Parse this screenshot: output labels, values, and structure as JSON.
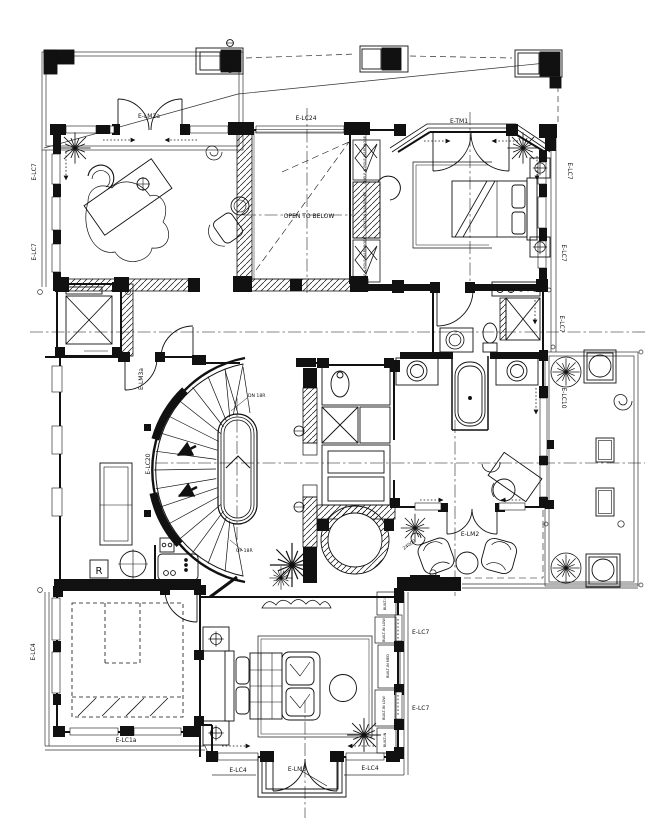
{
  "drawing": {
    "type": "architectural-floor-plan",
    "ink": "#111111",
    "paper": "#ffffff"
  },
  "annotations": {
    "open_to_below": "OPEN TO BELOW",
    "stairs_down": "DN 18R",
    "stairs_up": "UP 18R",
    "refrigerator": "R",
    "dimension": "24000"
  },
  "door_tags": {
    "study_entry": "E-LM2a",
    "hall_door": "E-LM3a",
    "terrace_doors": "E-LM2",
    "balcony_doors": "E-LM3",
    "bay_window": "E-TM1"
  },
  "finish_tags": {
    "lc7": "E-LC7",
    "lc24": "E-LC24",
    "lc10": "E-LC10",
    "lc20": "E-LC20",
    "lc4": "E-LC4",
    "lc1a": "E-LC1a"
  },
  "casework": {
    "shelf_pole": "SHELF & POLE WARDROBE",
    "built_in_wardrobe": "BUILT-IN WARDROBE",
    "built_in": "BUILT-IN",
    "built_in_low": "BUILT-IN LOW",
    "built_in_med": "BUILT-IN MED"
  }
}
